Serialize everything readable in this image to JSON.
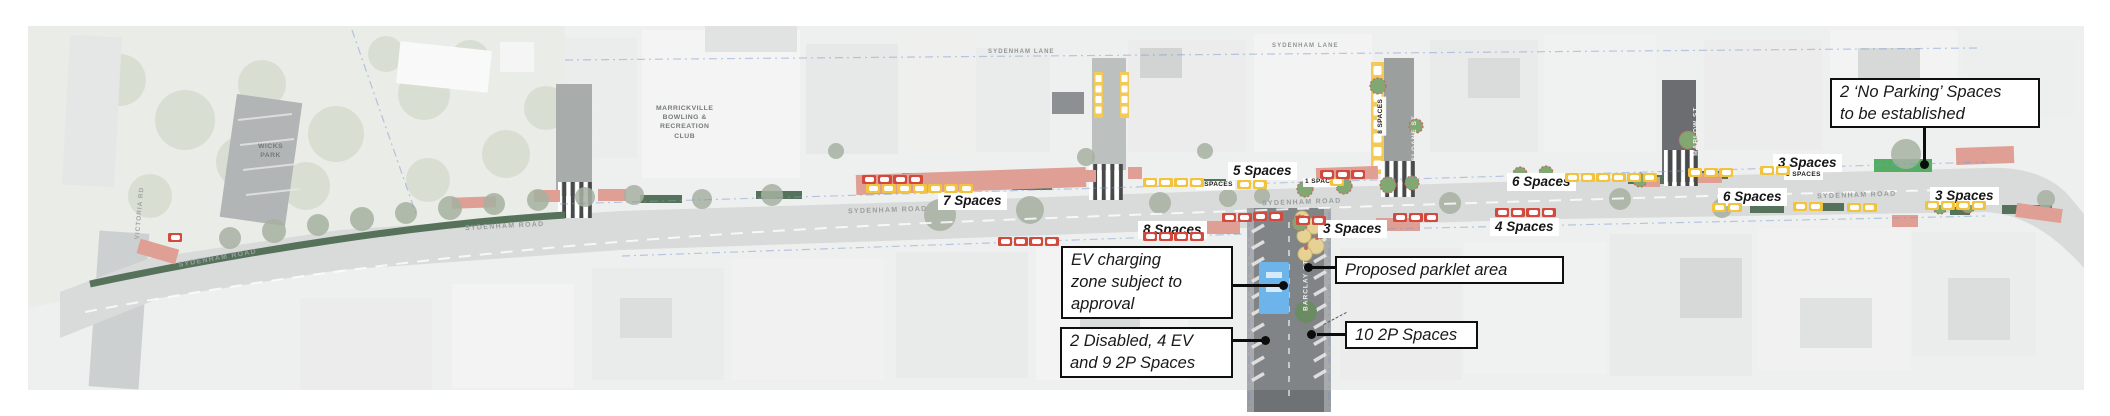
{
  "title": "Sydenham Road parking plan",
  "colors": {
    "map_background": "#eceeed",
    "road": "#d3d6d4",
    "side_street_dark": "#6f7274",
    "hedge_green": "#3f5d43",
    "kerb_extension_salmon": "#db9185",
    "bay_yellow": "#f2c33c",
    "bay_red": "#d2493e",
    "ev_zone_blue": "#58a9e9",
    "no_parking_green": "#3ba14b",
    "parklet_beige": "#e2cc85",
    "boundary_blue": "#6a8cc9"
  },
  "callouts": {
    "no_parking": {
      "text": "2 ‘No Parking’ Spaces\nto be established"
    },
    "ev": {
      "text": "EV charging\nzone subject to\napproval"
    },
    "parklet": {
      "text": "Proposed parklet area"
    },
    "disabled": {
      "text": "2 Disabled, 4 EV\nand 9 2P Spaces"
    },
    "p2": {
      "text": "10 2P Spaces"
    }
  },
  "labels": {
    "space_counts_large": [
      {
        "text": "7 Spaces",
        "x": 938,
        "y": 192
      },
      {
        "text": "8 Spaces",
        "x": 1138,
        "y": 221
      },
      {
        "text": "5 Spaces",
        "x": 1228,
        "y": 162
      },
      {
        "text": "3 Spaces",
        "x": 1318,
        "y": 220
      },
      {
        "text": "4 Spaces",
        "x": 1490,
        "y": 218
      },
      {
        "text": "6 Spaces",
        "x": 1507,
        "y": 173
      },
      {
        "text": "6 Spaces",
        "x": 1718,
        "y": 188
      },
      {
        "text": "3 Spaces",
        "x": 1773,
        "y": 154
      },
      {
        "text": "3 Spaces",
        "x": 1930,
        "y": 187
      }
    ],
    "space_counts_small": [
      {
        "text": "4 SPACES",
        "x": 1196,
        "y": 181,
        "rot": 0
      },
      {
        "text": "1 SPACE",
        "x": 1303,
        "y": 178,
        "rot": 0
      },
      {
        "text": "3 SPACES",
        "x": 1784,
        "y": 171,
        "rot": 0
      },
      {
        "text": "8 SPACES",
        "x": 1362,
        "y": 112,
        "rot": -90
      }
    ],
    "street_names": [
      {
        "text": "SYDENHAM ROAD",
        "x": 178,
        "y": 255,
        "rot": -10,
        "cls": "street-label"
      },
      {
        "text": "SYDENHAM ROAD",
        "x": 465,
        "y": 223,
        "rot": -3,
        "cls": "street-label"
      },
      {
        "text": "SYDENHAM ROAD",
        "x": 848,
        "y": 207,
        "rot": -2,
        "cls": "street-label"
      },
      {
        "text": "SYDENHAM ROAD",
        "x": 1262,
        "y": 199,
        "rot": -2,
        "cls": "street-label"
      },
      {
        "text": "SYDENHAM ROAD",
        "x": 1817,
        "y": 192,
        "rot": -2,
        "cls": "street-label"
      },
      {
        "text": "SYDENHAM LANE",
        "x": 988,
        "y": 49,
        "rot": 0,
        "cls": "lane-label"
      },
      {
        "text": "SYDENHAM LANE",
        "x": 1272,
        "y": 43,
        "rot": 0,
        "cls": "lane-label"
      },
      {
        "text": "FAVERSHAM ST",
        "x": 566,
        "y": 130,
        "rot": -90,
        "cls": "v-white"
      },
      {
        "text": "SLOANE ST",
        "x": 1392,
        "y": 135,
        "rot": -90,
        "cls": "v-white"
      },
      {
        "text": "MARLOW ST",
        "x": 1672,
        "y": 128,
        "rot": -90,
        "cls": "v-white"
      },
      {
        "text": "BARCLAY ST",
        "x": 1281,
        "y": 282,
        "rot": -90,
        "cls": "v-white"
      },
      {
        "text": "VICTORIA RD",
        "x": 114,
        "y": 210,
        "rot": -85,
        "cls": "v-grey"
      }
    ],
    "areas": [
      {
        "text": "WICKS\nPARK",
        "x": 258,
        "y": 142
      },
      {
        "text": "MARRICKVILLE\nBOWLING &\nRECREATION\nCLUB",
        "x": 656,
        "y": 104
      }
    ]
  },
  "car_rows": [
    {
      "x": 866,
      "y": 184,
      "n": 7,
      "c": "yellow"
    },
    {
      "x": 1143,
      "y": 178,
      "n": 4,
      "c": "yellow"
    },
    {
      "x": 1237,
      "y": 180,
      "n": 2,
      "c": "yellow"
    },
    {
      "x": 1330,
      "y": 177,
      "n": 1,
      "c": "yellow"
    },
    {
      "x": 1565,
      "y": 173,
      "n": 6,
      "c": "yellow"
    },
    {
      "x": 1688,
      "y": 168,
      "n": 3,
      "c": "yellow"
    },
    {
      "x": 1760,
      "y": 166,
      "n": 2,
      "c": "yellow"
    },
    {
      "x": 1925,
      "y": 201,
      "n": 4,
      "c": "yellow"
    },
    {
      "x": 1712,
      "y": 203,
      "n": 2,
      "c": "yellow"
    },
    {
      "x": 1793,
      "y": 202,
      "n": 2,
      "c": "yellow"
    },
    {
      "x": 1847,
      "y": 203,
      "n": 2,
      "c": "yellow"
    },
    {
      "x": 168,
      "y": 233,
      "n": 1,
      "c": "red"
    },
    {
      "x": 862,
      "y": 175,
      "n": 4,
      "c": "red"
    },
    {
      "x": 998,
      "y": 237,
      "n": 4,
      "c": "red"
    },
    {
      "x": 1143,
      "y": 232,
      "n": 4,
      "c": "red"
    },
    {
      "x": 1222,
      "y": 213,
      "n": 2,
      "c": "red"
    },
    {
      "x": 1253,
      "y": 212,
      "n": 2,
      "c": "red"
    },
    {
      "x": 1296,
      "y": 216,
      "n": 2,
      "c": "red"
    },
    {
      "x": 1320,
      "y": 170,
      "n": 3,
      "c": "red"
    },
    {
      "x": 1393,
      "y": 213,
      "n": 3,
      "c": "red"
    },
    {
      "x": 1495,
      "y": 208,
      "n": 4,
      "c": "red"
    }
  ]
}
